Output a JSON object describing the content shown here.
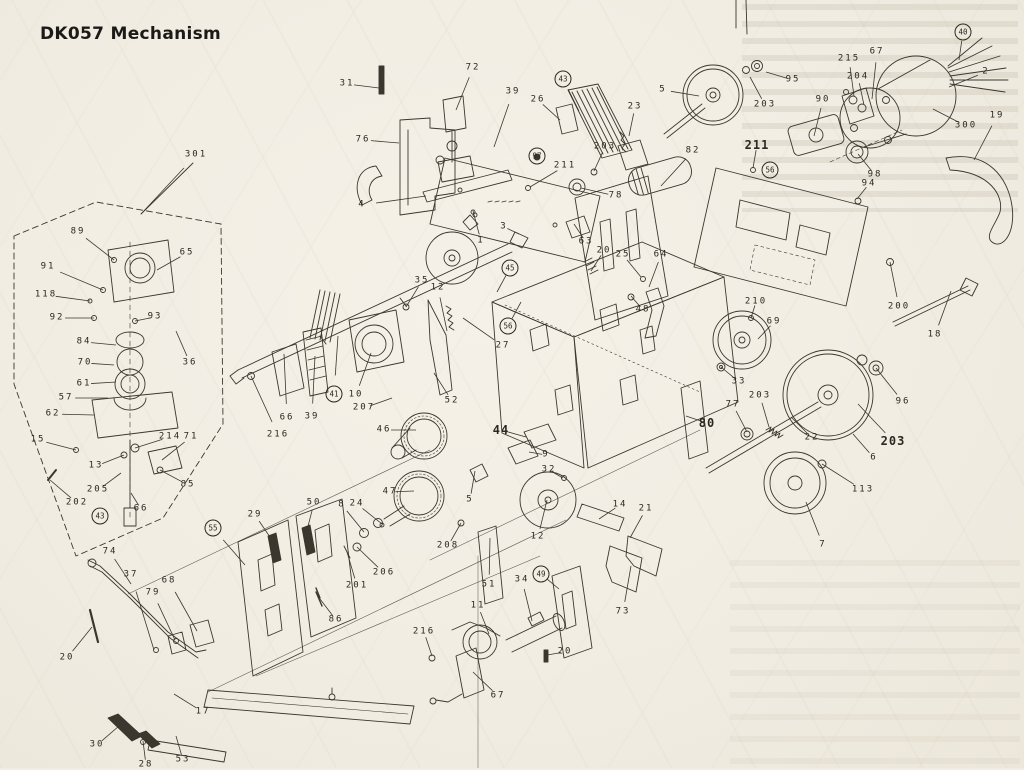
{
  "title": "DK057 Mechanism",
  "colors": {
    "paper": "#f1ede3",
    "ink": "#3b372f",
    "label": "#2b2722",
    "title": "#1c1a17"
  },
  "diagram": {
    "type": "exploded-parts-diagram",
    "labels": [
      {
        "t": "301",
        "x": 196,
        "y": 155,
        "tx": 141,
        "ty": 214
      },
      {
        "t": "89",
        "x": 78,
        "y": 232,
        "tx": 114,
        "ty": 260
      },
      {
        "t": "91",
        "x": 48,
        "y": 267,
        "tx": 103,
        "ty": 290
      },
      {
        "t": "118",
        "x": 46,
        "y": 295,
        "tx": 90,
        "ty": 301
      },
      {
        "t": "92",
        "x": 57,
        "y": 318,
        "tx": 94,
        "ty": 318
      },
      {
        "t": "93",
        "x": 155,
        "y": 317,
        "tx": 135,
        "ty": 321
      },
      {
        "t": "65",
        "x": 187,
        "y": 253,
        "tx": 157,
        "ty": 270
      },
      {
        "t": "36",
        "x": 190,
        "y": 363,
        "tx": 176,
        "ty": 331
      },
      {
        "t": "84",
        "x": 84,
        "y": 342,
        "tx": 116,
        "ty": 345
      },
      {
        "t": "70",
        "x": 85,
        "y": 363,
        "tx": 114,
        "ty": 365
      },
      {
        "t": "61",
        "x": 84,
        "y": 384,
        "tx": 116,
        "ty": 382
      },
      {
        "t": "57",
        "x": 66,
        "y": 398,
        "tx": 108,
        "ty": 398
      },
      {
        "t": "62",
        "x": 53,
        "y": 414,
        "tx": 94,
        "ty": 415
      },
      {
        "t": "15",
        "x": 38,
        "y": 440,
        "tx": 76,
        "ty": 450
      },
      {
        "t": "214",
        "x": 170,
        "y": 437,
        "tx": 135,
        "ty": 448
      },
      {
        "t": "71",
        "x": 191,
        "y": 437,
        "tx": 162,
        "ty": 460
      },
      {
        "t": "13",
        "x": 96,
        "y": 466,
        "tx": 124,
        "ty": 455
      },
      {
        "t": "205",
        "x": 98,
        "y": 490,
        "tx": 121,
        "ty": 473
      },
      {
        "t": "202",
        "x": 77,
        "y": 503,
        "tx": 50,
        "ty": 480
      },
      {
        "t": "85",
        "x": 188,
        "y": 485,
        "tx": 160,
        "ty": 470
      },
      {
        "t": "66",
        "x": 141,
        "y": 509,
        "tx": 131,
        "ty": 493
      },
      {
        "t": "43",
        "x": 100,
        "y": 516,
        "c": true
      },
      {
        "t": "74",
        "x": 110,
        "y": 552,
        "tx": 131,
        "ty": 584
      },
      {
        "t": "37",
        "x": 131,
        "y": 575,
        "tx": 154,
        "ty": 650
      },
      {
        "t": "79",
        "x": 153,
        "y": 593,
        "tx": 175,
        "ty": 640
      },
      {
        "t": "68",
        "x": 169,
        "y": 581,
        "tx": 197,
        "ty": 631
      },
      {
        "t": "20",
        "x": 67,
        "y": 658,
        "tx": 92,
        "ty": 627
      },
      {
        "t": "30",
        "x": 97,
        "y": 745,
        "tx": 119,
        "ty": 726
      },
      {
        "t": "28",
        "x": 146,
        "y": 765,
        "tx": 143,
        "ty": 741
      },
      {
        "t": "53",
        "x": 183,
        "y": 760,
        "tx": 176,
        "ty": 736
      },
      {
        "t": "17",
        "x": 203,
        "y": 712,
        "tx": 174,
        "ty": 694
      },
      {
        "t": "29",
        "x": 255,
        "y": 515,
        "tx": 274,
        "ty": 543
      },
      {
        "t": "50",
        "x": 314,
        "y": 503,
        "tx": 306,
        "ty": 534
      },
      {
        "t": "55",
        "x": 213,
        "y": 528,
        "c": true,
        "tx": 245,
        "ty": 565
      },
      {
        "t": "86",
        "x": 336,
        "y": 620,
        "tx": 320,
        "ty": 599
      },
      {
        "t": "216",
        "x": 278,
        "y": 435,
        "tx": 251,
        "ty": 376
      },
      {
        "t": "66",
        "x": 287,
        "y": 418,
        "tx": 284,
        "ty": 354
      },
      {
        "t": "39",
        "x": 312,
        "y": 417,
        "tx": 315,
        "ty": 356
      },
      {
        "t": "41",
        "x": 334,
        "y": 394,
        "c": true,
        "tx": 338,
        "ty": 336
      },
      {
        "t": "10",
        "x": 356,
        "y": 395,
        "tx": 371,
        "ty": 353
      },
      {
        "t": "207",
        "x": 364,
        "y": 408,
        "tx": 392,
        "ty": 398
      },
      {
        "t": "46",
        "x": 384,
        "y": 430,
        "tx": 416,
        "ty": 430
      },
      {
        "t": "35",
        "x": 422,
        "y": 281,
        "tx": 406,
        "ty": 307
      },
      {
        "t": "12",
        "x": 438,
        "y": 288,
        "tx": 447,
        "ty": 331
      },
      {
        "t": "45",
        "x": 510,
        "y": 268,
        "c": true,
        "tx": 497,
        "ty": 292
      },
      {
        "t": "56",
        "x": 508,
        "y": 326,
        "c": true,
        "tx": 521,
        "ty": 302
      },
      {
        "t": "27",
        "x": 503,
        "y": 346,
        "tx": 463,
        "ty": 318
      },
      {
        "t": "52",
        "x": 452,
        "y": 401,
        "tx": 434,
        "ty": 373
      },
      {
        "t": "44",
        "x": 501,
        "y": 430,
        "b": true,
        "tx": 526,
        "ty": 437
      },
      {
        "t": "9",
        "x": 546,
        "y": 455,
        "tx": 529,
        "ty": 452
      },
      {
        "t": "32",
        "x": 549,
        "y": 470,
        "tx": 563,
        "ty": 478
      },
      {
        "t": "47",
        "x": 390,
        "y": 492,
        "tx": 414,
        "ty": 491
      },
      {
        "t": "8",
        "x": 342,
        "y": 505,
        "tx": 364,
        "ty": 532
      },
      {
        "t": "24",
        "x": 357,
        "y": 504,
        "tx": 382,
        "ty": 524
      },
      {
        "t": "5",
        "x": 470,
        "y": 500,
        "tx": 475,
        "ty": 471
      },
      {
        "t": "208",
        "x": 448,
        "y": 546,
        "tx": 461,
        "ty": 523
      },
      {
        "t": "206",
        "x": 384,
        "y": 573,
        "tx": 357,
        "ty": 547
      },
      {
        "t": "201",
        "x": 357,
        "y": 586,
        "tx": 347,
        "ty": 552
      },
      {
        "t": "51",
        "x": 489,
        "y": 585,
        "tx": 490,
        "ty": 538
      },
      {
        "t": "12",
        "x": 538,
        "y": 537,
        "tx": 547,
        "ty": 500
      },
      {
        "t": "14",
        "x": 620,
        "y": 505,
        "tx": 599,
        "ty": 519
      },
      {
        "t": "21",
        "x": 646,
        "y": 509,
        "tx": 630,
        "ty": 538
      },
      {
        "t": "49",
        "x": 541,
        "y": 574,
        "c": true,
        "tx": 559,
        "ty": 589
      },
      {
        "t": "34",
        "x": 522,
        "y": 580,
        "tx": 532,
        "ty": 621
      },
      {
        "t": "73",
        "x": 623,
        "y": 612,
        "tx": 631,
        "ty": 566
      },
      {
        "t": "11",
        "x": 478,
        "y": 606,
        "tx": 489,
        "ty": 634
      },
      {
        "t": "216",
        "x": 424,
        "y": 632,
        "tx": 432,
        "ty": 656
      },
      {
        "t": "20",
        "x": 565,
        "y": 652,
        "tx": 547,
        "ty": 655
      },
      {
        "t": "67",
        "x": 498,
        "y": 696,
        "tx": 473,
        "ty": 672
      },
      {
        "t": "31",
        "x": 347,
        "y": 84,
        "tx": 379,
        "ty": 88
      },
      {
        "t": "72",
        "x": 473,
        "y": 68,
        "tx": 456,
        "ty": 110
      },
      {
        "t": "76",
        "x": 363,
        "y": 140,
        "tx": 399,
        "ty": 143
      },
      {
        "t": "4",
        "x": 362,
        "y": 205,
        "tx": 426,
        "ty": 196
      },
      {
        "t": "39",
        "x": 513,
        "y": 92,
        "tx": 494,
        "ty": 147
      },
      {
        "t": "26",
        "x": 538,
        "y": 100,
        "tx": 560,
        "ty": 120
      },
      {
        "t": "43",
        "x": 563,
        "y": 79,
        "c": true,
        "tx": 579,
        "ty": 111
      },
      {
        "t": "23",
        "x": 635,
        "y": 107,
        "tx": 629,
        "ty": 136
      },
      {
        "t": "203",
        "x": 605,
        "y": 147,
        "tx": 594,
        "ty": 171
      },
      {
        "t": "211",
        "x": 565,
        "y": 166,
        "tx": 530,
        "ty": 187
      },
      {
        "t": "97",
        "x": 537,
        "y": 156,
        "c": true
      },
      {
        "t": "1",
        "x": 481,
        "y": 241,
        "tx": 473,
        "ty": 211
      },
      {
        "t": "3",
        "x": 504,
        "y": 227,
        "tx": 519,
        "ty": 234
      },
      {
        "t": "78",
        "x": 616,
        "y": 196,
        "tx": 581,
        "ty": 188
      },
      {
        "t": "63",
        "x": 586,
        "y": 242,
        "tx": 574,
        "ty": 224
      },
      {
        "t": "20",
        "x": 604,
        "y": 251,
        "tx": 591,
        "ty": 271
      },
      {
        "t": "25",
        "x": 623,
        "y": 255,
        "tx": 641,
        "ty": 277
      },
      {
        "t": "64",
        "x": 661,
        "y": 255,
        "tx": 649,
        "ty": 287
      },
      {
        "t": "48",
        "x": 643,
        "y": 310,
        "tx": 631,
        "ty": 296
      },
      {
        "t": "5",
        "x": 663,
        "y": 90,
        "tx": 699,
        "ty": 96
      },
      {
        "t": "95",
        "x": 793,
        "y": 80,
        "tx": 766,
        "ty": 72
      },
      {
        "t": "215",
        "x": 849,
        "y": 59,
        "tx": 854,
        "ty": 96
      },
      {
        "t": "67",
        "x": 877,
        "y": 52,
        "tx": 872,
        "ty": 99
      },
      {
        "t": "204",
        "x": 858,
        "y": 77,
        "tx": 864,
        "ty": 105
      },
      {
        "t": "90",
        "x": 823,
        "y": 100,
        "tx": 814,
        "ty": 136
      },
      {
        "t": "203",
        "x": 765,
        "y": 105,
        "tx": 750,
        "ty": 77
      },
      {
        "t": "211",
        "x": 757,
        "y": 145,
        "b": true,
        "tx": 753,
        "ty": 168
      },
      {
        "t": "82",
        "x": 693,
        "y": 151,
        "tx": 661,
        "ty": 186
      },
      {
        "t": "98",
        "x": 875,
        "y": 175,
        "tx": 858,
        "ty": 154
      },
      {
        "t": "94",
        "x": 869,
        "y": 184,
        "tx": 857,
        "ty": 199
      },
      {
        "t": "300",
        "x": 966,
        "y": 126,
        "tx": 933,
        "ty": 109
      },
      {
        "t": "2",
        "x": 986,
        "y": 72,
        "tx": 949,
        "ty": 87
      },
      {
        "t": "19",
        "x": 997,
        "y": 116,
        "tx": 974,
        "ty": 160
      },
      {
        "t": "40",
        "x": 963,
        "y": 32,
        "c": true,
        "tx": 959,
        "ty": 60
      },
      {
        "t": "56",
        "x": 770,
        "y": 170,
        "c": true
      },
      {
        "t": "200",
        "x": 899,
        "y": 307,
        "tx": 890,
        "ty": 262
      },
      {
        "t": "18",
        "x": 935,
        "y": 335,
        "tx": 951,
        "ty": 291
      },
      {
        "t": "210",
        "x": 756,
        "y": 302,
        "tx": 751,
        "ty": 318
      },
      {
        "t": "69",
        "x": 774,
        "y": 322,
        "tx": 758,
        "ty": 339
      },
      {
        "t": "33",
        "x": 739,
        "y": 382,
        "tx": 721,
        "ty": 367
      },
      {
        "t": "80",
        "x": 707,
        "y": 423,
        "b": true,
        "tx": 686,
        "ty": 416
      },
      {
        "t": "77",
        "x": 733,
        "y": 405,
        "tx": 747,
        "ty": 432
      },
      {
        "t": "203",
        "x": 760,
        "y": 396,
        "tx": 769,
        "ty": 427
      },
      {
        "t": "22",
        "x": 812,
        "y": 438,
        "tx": 791,
        "ty": 417
      },
      {
        "t": "96",
        "x": 903,
        "y": 402,
        "tx": 876,
        "ty": 368
      },
      {
        "t": "203",
        "x": 893,
        "y": 441,
        "b": true,
        "tx": 858,
        "ty": 404
      },
      {
        "t": "6",
        "x": 874,
        "y": 458,
        "tx": 853,
        "ty": 434
      },
      {
        "t": "113",
        "x": 863,
        "y": 490,
        "tx": 822,
        "ty": 464
      },
      {
        "t": "7",
        "x": 823,
        "y": 545,
        "tx": 806,
        "ty": 502
      }
    ]
  }
}
